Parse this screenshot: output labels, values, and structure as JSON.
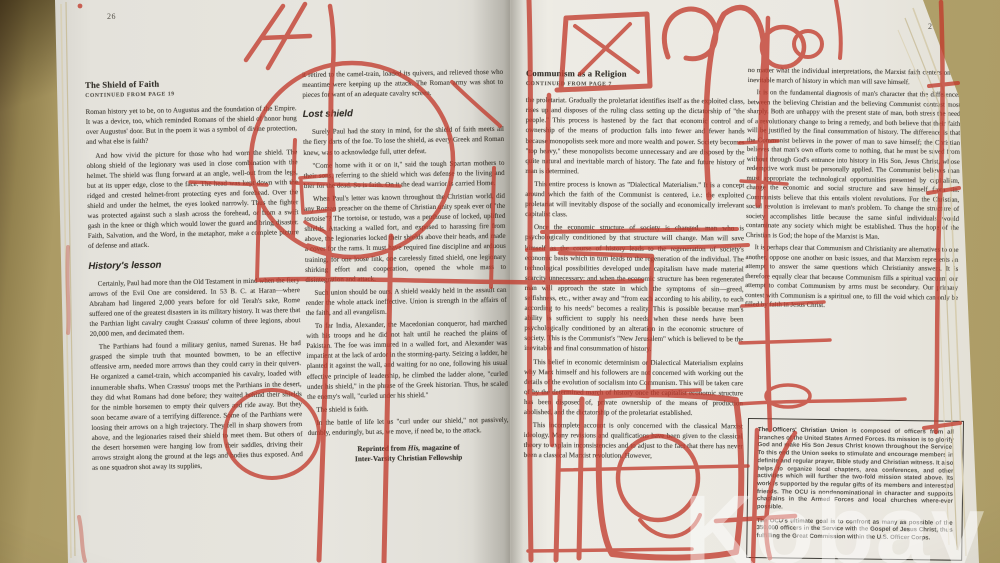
{
  "photo": {
    "watermark": "Kobay",
    "marker_color": "#c23b2c"
  },
  "left_page": {
    "page_number": "26",
    "col1": {
      "heading": "The Shield of Faith",
      "continued": "CONTINUED FROM PAGE 19",
      "paras": [
        "Roman history yet to be, on to Augustus and the foundation of the Empire. It was a device, too, which reminded Romans of the shield of honor hung over Augustus' door. But in the poem it was a symbol of divine protection, and what else is faith?",
        "And how vivid the picture for those who had worn the shield. The oblong shield of the legionary was used in close combination with the helmet. The shield was flung forward at an angle, well-out from the legs, but at its upper edge, close to the face. The head was kept down with the ridged and crested helmet-front protecting eyes and forehead. Over the shield and under the helmet, the eyes looked narrowly. Thus the fighter was protected against such a slash across the forehead, or from a swift gash in the knee or thigh which would lower the guard and bring disaster. Faith, Salvation, and the Word, in the metaphor, make a complete picture of defense and attack."
      ],
      "subheading": "History's lesson",
      "paras2": [
        "Certainly, Paul had more than the Old Testament in mind when the fiery arrows of the Evil One are considered. In 53 B. C. at Haran—where Abraham had lingered 2,000 years before for old Terah's sake, Rome suffered one of the greatest disasters in its military history. It was there that the Parthian light cavalry caught Crassus' column of three legions, about 20,000 men, and decimated them.",
        "The Parthians had found a military genius, named Surenas. He had grasped the simple truth that mounted bowmen, to be an effective offensive arm, needed more arrows than they could carry in their quivers. He organized a camel-train, which accompanied his cavalry, loaded with innumerable shafts. When Crassus' troops met the Parthians in the desert, they did what Romans had done before; they waited behind their shields for the nimble horsemen to empty their quivers and ride away. But they soon became aware of a terrifying difference. Some of the Parthians were loosing their arrows on a high trajectory. They fell in sharp showers from above, and the legionaries raised their shield to meet them. But others of the desert horsemen were hanging low from their saddles, driving their arrows straight along the ground at the legs and bodies thus exposed. And as one squadron shot away its supplies,"
      ]
    },
    "col2": {
      "para_top": "it retired to the camel-train, loaded its quivers, and relieved those who meantime were keeping up the attack. The Roman army was shot to pieces for want of an adequate cavalry screen.",
      "subheading": "Lost shield",
      "paras": [
        "Surely Paul had the story in mind, for the shield of faith meets all the fiery darts of the foe. To lose the shield, as every Greek and Roman knew, was to acknowledge full, utter defeat.",
        "\"Come home with it or on it,\" said the tough Spartan mothers to their sons, referring to the shield which was defense to the living and bier for the dead. So is faith. On it the dead warrior is carried Home.",
        "When Paul's letter was known throughout the Christian world, did any Roman preacher on the theme of Christian unity speak ever of \"the tortoise\"? The tortoise, or testudo, was a penthouse of locked, uplifted shields. Attacking a walled fort, and exposed to harassing fire from above, the legionaries locked their shields above their heads, and made a cover for the rams. It must have required fine discipline and arduous training, for one loose link, one carelessly fitted shield, one legionary shirking effort and cooperation, opened the whole mass to disintegration and attack.",
        "Such union should be ours. A shield weakly held in the assault can render the whole attack ineffective. Union is strength in the affairs of the faith, and all evangelism.",
        "To far India, Alexander, the Macedonian conqueror, had marched with his troops and he did not halt until he reached the plains of Pakistan. The foe was immured in a walled fort, and Alexander was impatient at the lack of ardor in the storming-party. Seizing a ladder, he planted it against the wall, and waiting for no one, following his usual effective principle of leadership, he climbed the ladder alone, \"curled under his shield,\" in the phrase of the Greek historian. Thus, he scaled the enemy's wall, \"curled under his shield.\"",
        "The shield is faith.",
        "In the battle of life let us \"curl under our shield,\" not passively, dumbly, enduringly, but as, we move, if need be, to the attack."
      ],
      "credit_prefix": "Reprinted from ",
      "credit_his": "His,",
      "credit_suffix": " magazine of",
      "credit_line2": "Inter-Varsity Christian Fellowship"
    }
  },
  "right_page": {
    "page_number": "27",
    "col1": {
      "heading": "Communism as a Religion",
      "continued": "CONTINUED FROM PAGE 7",
      "paras": [
        "the proletariat. Gradually the proletariat identifies itself as the exploited class, rises up and disposes of the ruling class setting up the dictatorship of \"the people.\" This process is hastened by the fact that economic control and ownership of the means of production falls into fewer and fewer hands because monopolists seek more and more wealth and power. Society becomes \"top heavy,\" these monopolists become unnecessary and are disposed by the quite natural and inevitable march of history. The fate and future history of man is determined.",
        "This entire process is known as \"Dialectical Materialism.\" It is a concept around which the faith of the Communist is centered, i.e.: the exploited proletariat will inevitably dispose of the socially and economically irrelevant capitalist class.",
        "Once the economic structure of society is changed, man who is psychologically conditioned by that structure will change. Man will save himself as the course of history leads to the regeneration of society's economic basis which in turn leads to the regeneration of the individual. The technological possibilities developed under capitalism have made material scarcity unnecessary; and when the economic structure has been regenerated man will approach the state in which the symptoms of sin—greed, selfishness, etc., wither away and \"from each according to his ability, to each according to his needs\" becomes a reality. This is possible because man's ability is sufficient to supply his needs when these needs have been psychologically conditioned by an alteration in the economic structure of society. This is the Communist's \"New Jerusalem\" which is believed to be the inevitable and final consummation of history.",
        "This belief in economic determinism or Dialectical Materialism explains why Marx himself and his followers are not concerned with working out the details of the evolution of socialism into Communism. This will be taken care of by the determined march of history once the capitalist economic structure has been disposed of, private ownership of the means of production abolished, and the dictatorship of the proletariat established.",
        "This incomplete account is only concerned with the classical Marxist ideology. Many revisions and qualifications have been given to the classical theory to explain inconsistencies and to adjust to the fact that there has never been a classical Marxist revolution. However,"
      ]
    },
    "col2": {
      "paras": [
        "no matter what the individual interpretations, the Marxist faith centers on the inevitable march of history in which man will save himself.",
        "It is on the fundamental diagnosis of man's character that the differences between the believing Christian and the believing Communist contrast most sharply. Both are unhappy with the present state of man, both stress the need of a revolutionary change to bring a remedy, and both believe that their faith will be justified by the final consummation of history. The difference is that the Communist believes in the power of man to save himself; the Christian believes that man's own efforts come to nothing, that he must be saved from without through God's entrance into history in His Son, Jesus Christ, whose redemptive work must be personally applied. The Communist believes man must appropriate the technological opportunities presented by capitalism, change the economic and social structure and save himself from sin. Communists believe that this entails violent revolutions. For the Christian, social revolution is irrelevant to man's problem. To change the structure of society accomplishes little because the same sinful individuals would contaminate any society which might be established. Thus the hope of the Christian is God; the hope of the Marxist is Man.",
        "It is perhaps clear that Communism and Christianity are alternatives to one another, oppose one another on basic issues, and that Marxism represents an attempt to answer the same questions which Christianity answers. It is therefore equally clear that because Communism fills a spiritual vacuum our attempt to combat Communism by arms must be secondary. Our primary contest with Communism is a spiritual one, to fill the void which can only be filled by faith in Jesus Christ."
      ],
      "box": {
        "title": "The Officers' Christian Union",
        "para1_rest": " is composed of officers from all branches of the United States Armed Forces. Its mission is to glorify God and make His Son Jesus Christ known throughout the Service. To this end the Union seeks to stimulate and encourage members in definite and regular prayer, Bible study and Christian witness. It also helps to organize local chapters, area conferences, and other activities which will further the two-fold mission stated above. Its work is supported by the regular gifts of its members and interested friends. The OCU is nondenominational in character and supports chaplains in the Armed Forces and local churches where-ever possible.",
        "para2": "The OCU's ultimate goal is to confront as many as possible of the 350,000 officers in the Service with the Gospel of Jesus Christ, thus fulfilling the Great Commission within the U.S. Officer Corps."
      }
    }
  }
}
